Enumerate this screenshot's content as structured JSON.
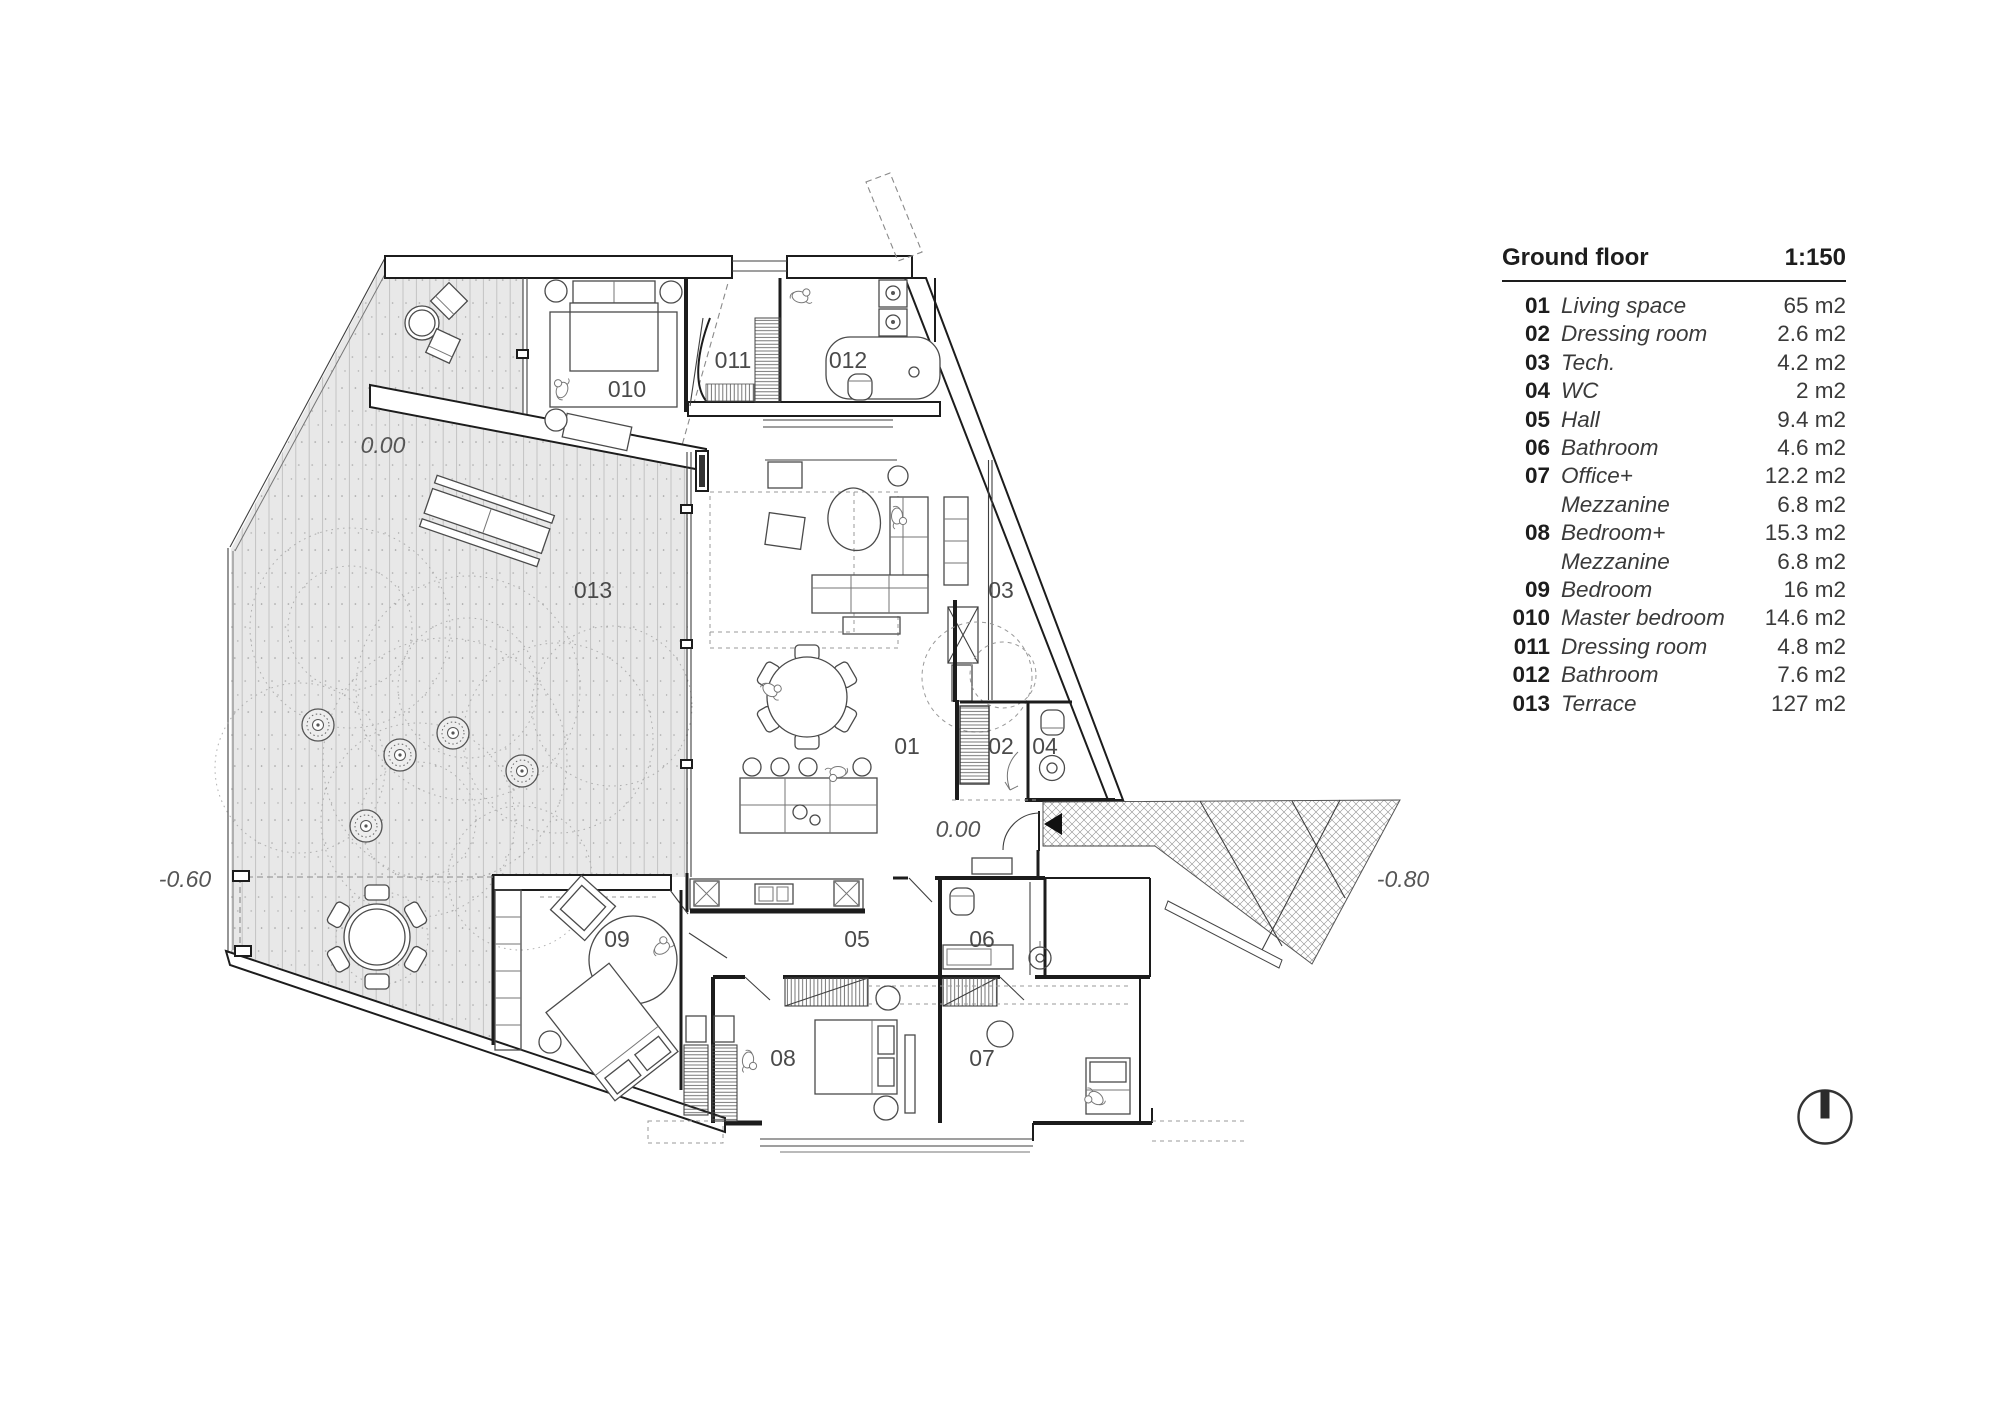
{
  "legend": {
    "title": "Ground floor",
    "scale": "1:150",
    "rows": [
      {
        "no": "01",
        "name": "Living space",
        "area": "65 m2"
      },
      {
        "no": "02",
        "name": "Dressing room",
        "area": "2.6 m2"
      },
      {
        "no": "03",
        "name": "Tech.",
        "area": "4.2 m2"
      },
      {
        "no": "04",
        "name": "WC",
        "area": "2 m2"
      },
      {
        "no": "05",
        "name": "Hall",
        "area": "9.4 m2"
      },
      {
        "no": "06",
        "name": "Bathroom",
        "area": "4.6 m2"
      },
      {
        "no": "07",
        "name": "Office+",
        "area": "12.2 m2"
      },
      {
        "no": "",
        "name": "Mezzanine",
        "area": "6.8 m2"
      },
      {
        "no": "08",
        "name": "Bedroom+",
        "area": "15.3 m2"
      },
      {
        "no": "",
        "name": "Mezzanine",
        "area": "6.8 m2"
      },
      {
        "no": "09",
        "name": "Bedroom",
        "area": "16 m2"
      },
      {
        "no": "010",
        "name": "Master bedroom",
        "area": "14.6 m2"
      },
      {
        "no": "011",
        "name": "Dressing room",
        "area": "4.8 m2"
      },
      {
        "no": "012",
        "name": "Bathroom",
        "area": "7.6 m2"
      },
      {
        "no": "013",
        "name": "Terrace",
        "area": "127 m2"
      }
    ]
  },
  "plan": {
    "room_labels": [
      {
        "text": "010",
        "x": 627,
        "y": 391
      },
      {
        "text": "011",
        "x": 733,
        "y": 362
      },
      {
        "text": "012",
        "x": 848,
        "y": 362
      },
      {
        "text": "013",
        "x": 593,
        "y": 592
      },
      {
        "text": "03",
        "x": 1001,
        "y": 592
      },
      {
        "text": "01",
        "x": 907,
        "y": 748
      },
      {
        "text": "02",
        "x": 1001,
        "y": 748
      },
      {
        "text": "04",
        "x": 1045,
        "y": 748
      },
      {
        "text": "05",
        "x": 857,
        "y": 941
      },
      {
        "text": "06",
        "x": 982,
        "y": 941
      },
      {
        "text": "09",
        "x": 617,
        "y": 941
      },
      {
        "text": "08",
        "x": 783,
        "y": 1060
      },
      {
        "text": "07",
        "x": 982,
        "y": 1060
      }
    ],
    "level_labels": [
      {
        "text": "0.00",
        "x": 383,
        "y": 447
      },
      {
        "text": "0.00",
        "x": 958,
        "y": 831
      },
      {
        "text": "-0.60",
        "x": 185,
        "y": 881
      },
      {
        "text": "-0.80",
        "x": 1403,
        "y": 881
      }
    ]
  },
  "colors": {
    "wall": "#1c1c1c",
    "deck_fill": "#e8e8e8",
    "deck_stripe": "#c3c3c3",
    "hatch": "#8f8f8f",
    "label": "#4a4a4a"
  }
}
